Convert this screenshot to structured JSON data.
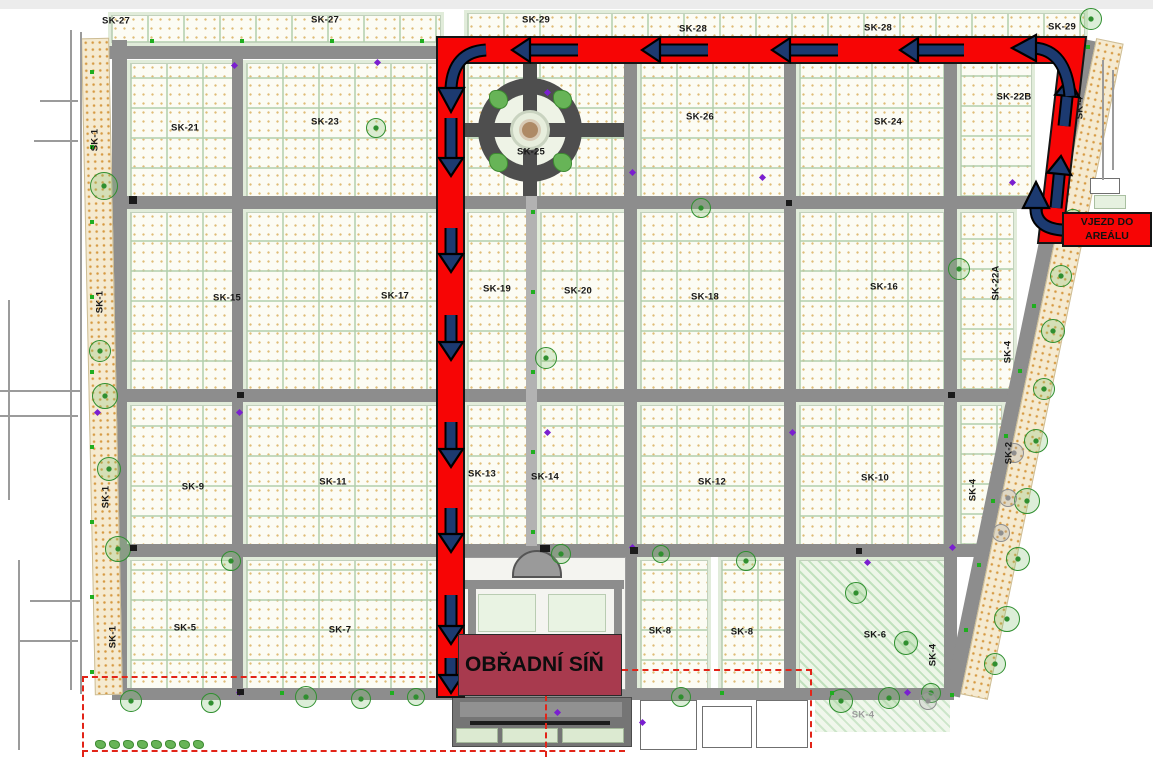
{
  "map": {
    "description_labels": {
      "entrance_line1": "VJEZD DO",
      "entrance_line2": "AREÁLU",
      "destination": "OBŘADNÍ SÍŇ"
    },
    "route": {
      "color": "#f70505",
      "outline_color": "#151515",
      "arrow_color": "#1c3a70",
      "entrance_box_color": "#f70505",
      "destination_box_color": "#a83a4e"
    },
    "sections": [
      {
        "label": "SK-27",
        "x": 116,
        "y": 21
      },
      {
        "label": "SK-27",
        "x": 325,
        "y": 20
      },
      {
        "label": "SK-29",
        "x": 536,
        "y": 20
      },
      {
        "label": "SK-28",
        "x": 693,
        "y": 29
      },
      {
        "label": "SK-28",
        "x": 878,
        "y": 28
      },
      {
        "label": "SK-29",
        "x": 1062,
        "y": 27
      },
      {
        "label": "SK-21",
        "x": 185,
        "y": 128
      },
      {
        "label": "SK-23",
        "x": 325,
        "y": 122
      },
      {
        "label": "SK-25",
        "x": 531,
        "y": 152
      },
      {
        "label": "SK-26",
        "x": 700,
        "y": 117
      },
      {
        "label": "SK-24",
        "x": 888,
        "y": 122
      },
      {
        "label": "SK-22B",
        "x": 1014,
        "y": 97
      },
      {
        "label": "SK-4",
        "x": 1080,
        "y": 108,
        "vertical": true
      },
      {
        "label": "SK-1",
        "x": 95,
        "y": 140,
        "vertical": true
      },
      {
        "label": "SK-15",
        "x": 227,
        "y": 298
      },
      {
        "label": "SK-17",
        "x": 395,
        "y": 296
      },
      {
        "label": "SK-19",
        "x": 497,
        "y": 289
      },
      {
        "label": "SK-20",
        "x": 578,
        "y": 291
      },
      {
        "label": "SK-18",
        "x": 705,
        "y": 297
      },
      {
        "label": "SK-16",
        "x": 884,
        "y": 287
      },
      {
        "label": "SK-22A",
        "x": 996,
        "y": 283,
        "vertical": true
      },
      {
        "label": "SK-4",
        "x": 1008,
        "y": 352,
        "vertical": true
      },
      {
        "label": "SK-1",
        "x": 100,
        "y": 302,
        "vertical": true
      },
      {
        "label": "SK-9",
        "x": 193,
        "y": 487
      },
      {
        "label": "SK-11",
        "x": 333,
        "y": 482
      },
      {
        "label": "SK-13",
        "x": 482,
        "y": 474
      },
      {
        "label": "SK-14",
        "x": 545,
        "y": 477
      },
      {
        "label": "SK-12",
        "x": 712,
        "y": 482
      },
      {
        "label": "SK-10",
        "x": 875,
        "y": 478
      },
      {
        "label": "SK-2",
        "x": 1009,
        "y": 453,
        "vertical": true
      },
      {
        "label": "SK-4",
        "x": 973,
        "y": 490,
        "vertical": true
      },
      {
        "label": "SK-1",
        "x": 106,
        "y": 497,
        "vertical": true
      },
      {
        "label": "SK-5",
        "x": 185,
        "y": 628
      },
      {
        "label": "SK-7",
        "x": 340,
        "y": 630
      },
      {
        "label": "SK-8",
        "x": 660,
        "y": 631
      },
      {
        "label": "SK-8",
        "x": 742,
        "y": 632
      },
      {
        "label": "SK-6",
        "x": 875,
        "y": 635
      },
      {
        "label": "SK-4",
        "x": 933,
        "y": 655,
        "vertical": true
      },
      {
        "label": "SK-1",
        "x": 113,
        "y": 637,
        "vertical": true
      },
      {
        "label": "SK-4",
        "x": 863,
        "y": 715,
        "muted": true
      }
    ]
  }
}
